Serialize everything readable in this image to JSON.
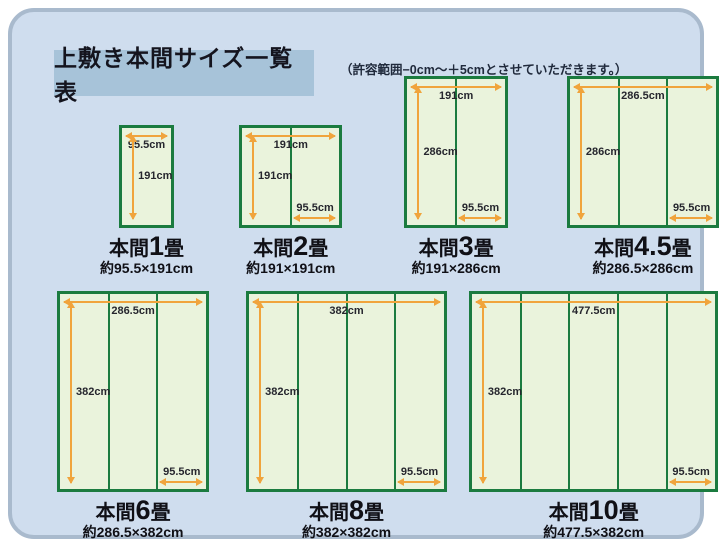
{
  "page": {
    "title": "上敷き本間サイズ一覧表",
    "note": "（許容範囲−0cm〜＋5cmとさせていただきます。）"
  },
  "colors": {
    "panel_bg": "#cfddee",
    "panel_border": "#a9bacd",
    "title_bg": "#a7c3d9",
    "mat_fill": "#eaf3dc",
    "mat_border": "#1b7b3f",
    "arrow": "#f0a43c",
    "ink": "#14141e"
  },
  "diagrams": [
    {
      "id": "honma-1jo",
      "row": 1,
      "prefix": "本間",
      "num": "1",
      "suffix": "畳",
      "size_label": "約95.5×191cm",
      "width_cm": 95.5,
      "height_cm": 191,
      "columns": 1,
      "top_label": "95.5cm",
      "left_label": "191cm",
      "col_label": null
    },
    {
      "id": "honma-2jo",
      "row": 1,
      "prefix": "本間",
      "num": "2",
      "suffix": "畳",
      "size_label": "約191×191cm",
      "width_cm": 191,
      "height_cm": 191,
      "columns": 2,
      "top_label": "191cm",
      "left_label": "191cm",
      "col_label": "95.5cm"
    },
    {
      "id": "honma-3jo",
      "row": 1,
      "prefix": "本間",
      "num": "3",
      "suffix": "畳",
      "size_label": "約191×286cm",
      "width_cm": 191,
      "height_cm": 286,
      "columns": 2,
      "top_label": "191cm",
      "left_label": "286cm",
      "col_label": "95.5cm"
    },
    {
      "id": "honma-4-5jo",
      "row": 1,
      "prefix": "本間",
      "num": "4.5",
      "suffix": "畳",
      "size_label": "約286.5×286cm",
      "width_cm": 286.5,
      "height_cm": 286,
      "columns": 3,
      "top_label": "286.5cm",
      "left_label": "286cm",
      "col_label": "95.5cm"
    },
    {
      "id": "honma-6jo",
      "row": 2,
      "prefix": "本間",
      "num": "6",
      "suffix": "畳",
      "size_label": "約286.5×382cm",
      "width_cm": 286.5,
      "height_cm": 382,
      "columns": 3,
      "top_label": "286.5cm",
      "left_label": "382cm",
      "col_label": "95.5cm"
    },
    {
      "id": "honma-8jo",
      "row": 2,
      "prefix": "本間",
      "num": "8",
      "suffix": "畳",
      "size_label": "約382×382cm",
      "width_cm": 382,
      "height_cm": 382,
      "columns": 4,
      "top_label": "382cm",
      "left_label": "382cm",
      "col_label": "95.5cm"
    },
    {
      "id": "honma-10jo",
      "row": 2,
      "prefix": "本間",
      "num": "10",
      "suffix": "畳",
      "size_label": "約477.5×382cm",
      "width_cm": 477.5,
      "height_cm": 382,
      "columns": 5,
      "top_label": "477.5cm",
      "left_label": "382cm",
      "col_label": "95.5cm"
    }
  ]
}
